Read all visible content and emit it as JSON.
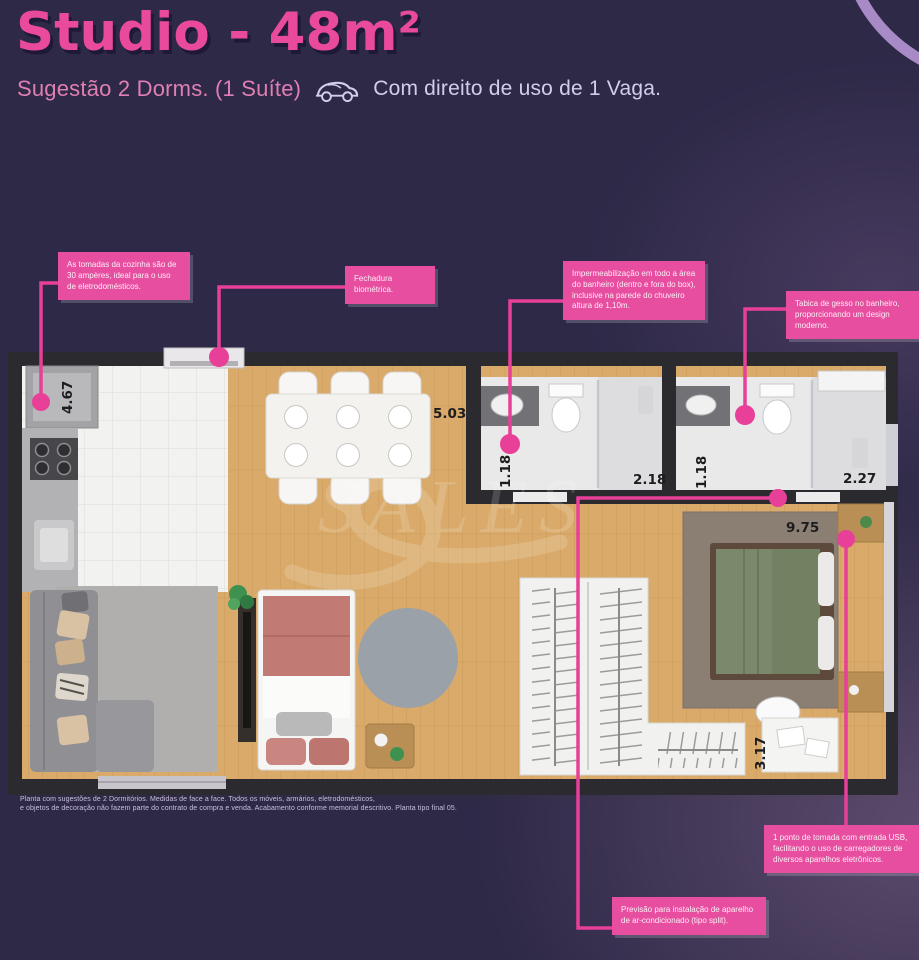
{
  "header": {
    "title": "Studio - 48m²",
    "suggestion": "Sugestão 2 Dorms. (1 Suíte)",
    "parking": "Com direito de uso de 1 Vaga."
  },
  "callouts": {
    "kitchen_outlets": {
      "text": "As tomadas da cozinha são de 30 ampères, ideal para o uso de eletrodomésticos."
    },
    "biometric_lock": {
      "text": "Fechadura biométrica."
    },
    "waterproofing": {
      "text": "Impermeabilização em todo a área do banheiro (dentro e fora do box), inclusive na parede do chuveiro altura de 1,10m."
    },
    "plaster_molding": {
      "text": "Tabica de gesso no banheiro, proporcionando um design moderno."
    },
    "usb_outlet": {
      "text": "1 ponto de tomada com entrada USB, facilitando o uso de carregadores de diversos aparelhos eletrônicos."
    },
    "air_conditioning": {
      "text": "Previsão para instalação de aparelho de ar-condicionado (tipo split)."
    }
  },
  "dimensions": {
    "kitchen": "4.67",
    "living": "5.03",
    "bath1_width": "1.18",
    "bath1_length": "2.18",
    "suite_bath_width": "1.18",
    "suite_bath_length": "2.27",
    "bedroom": "9.75",
    "closet": "3.17"
  },
  "watermark": {
    "text": "SALES"
  },
  "disclaimer": {
    "line1": "Planta com sugestões de 2 Dormitórios. Medidas de face a face. Todos os móveis, armários, eletrodomésticos,",
    "line2": "e objetos de decoração não fazem parte do contrato de compra e venda. Acabamento conforme memorial descritivo. Planta tipo final 05."
  },
  "colors": {
    "accent_pink": "#e83f98",
    "title_pink": "#ea4a9c",
    "background_purple": "#2e2947",
    "lavender_text": "#d3cdea",
    "wall_dark": "#2b2a2f",
    "wood_floor": "#d9aa69"
  }
}
